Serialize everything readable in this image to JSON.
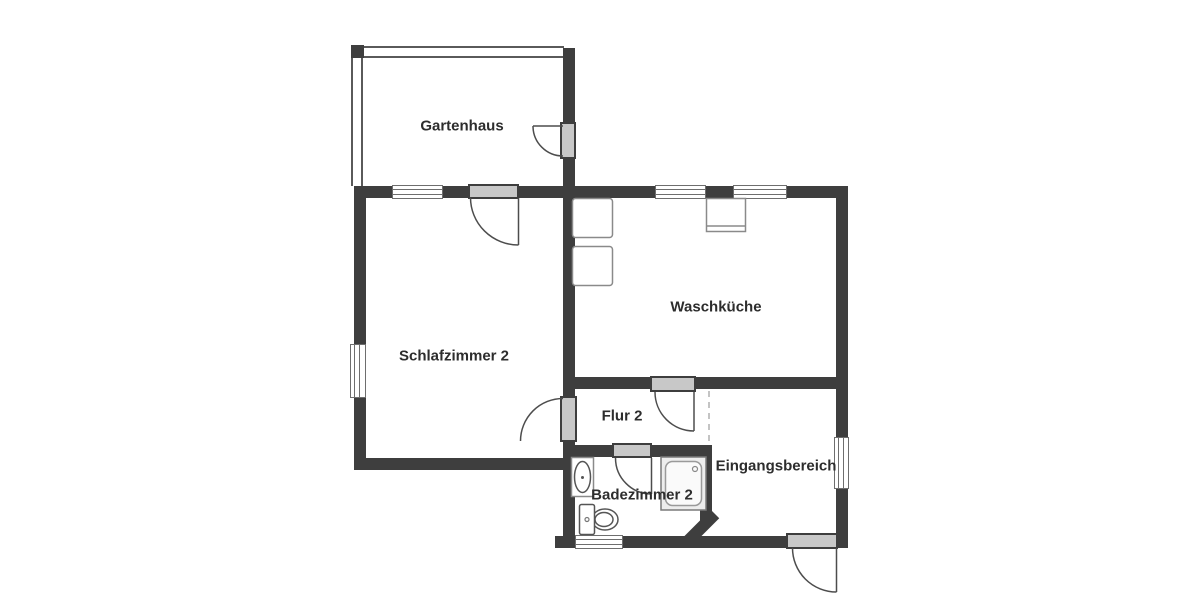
{
  "plan": {
    "title": "Grundriss / floor plan",
    "rooms": [
      {
        "id": "gartenhaus",
        "label": "Gartenhaus"
      },
      {
        "id": "schlafzimmer-2",
        "label": "Schlafzimmer 2"
      },
      {
        "id": "waschkueche",
        "label": "Waschküche"
      },
      {
        "id": "flur-2",
        "label": "Flur 2"
      },
      {
        "id": "badezimmer-2",
        "label": "Badezimmer 2"
      },
      {
        "id": "eingangsbereich",
        "label": "Eingangsbereich"
      }
    ],
    "fixtures": [
      "washing-machine",
      "washing-machine",
      "utility-sink",
      "shower",
      "washbasin",
      "toilet"
    ],
    "symbols": {
      "doors": 6,
      "windows": 6,
      "dashed_opening": 1
    },
    "colors": {
      "background": "#ffffff",
      "wall": "#3e3e3e",
      "light_wall": "#5a5a5a",
      "door_panel": "#c8c8c8",
      "door_arc": "#4d4d4d",
      "window_border": "#6e6e6e",
      "fixture": "#8a8a8a",
      "dashed": "#c4c4c4",
      "label": "#2d2d2d"
    }
  }
}
